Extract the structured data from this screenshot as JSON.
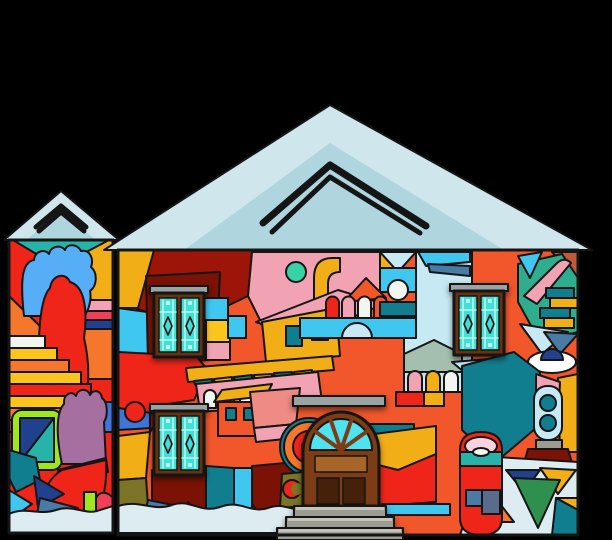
{
  "scene": {
    "type": "illustration",
    "description": "Colorful abstract mural covering the facades of two adjoining houses with pale-blue gabled roofs, an arched brown double door with cyan fanlight, three brown-framed teal-glass windows and gray entry steps, on a black background",
    "background": "#000000",
    "house_count": 2,
    "window_count": 3,
    "door_step_count": 3
  },
  "palette": {
    "roof_light": "#cfe7ec",
    "roof_mid": "#afd6de",
    "roof_ridge": "#eaf5f7",
    "red": "#f0251a",
    "crimson": "#f04058",
    "dark_red": "#9c1508",
    "wine": "#7a1205",
    "orange_red": "#f2572c",
    "orange": "#f4772b",
    "gold": "#f2ae17",
    "yellow": "#fcc51e",
    "off_white": "#f2f6f1",
    "white": "#ffffff",
    "pink": "#f2a3b3",
    "pale_pink": "#f6d4de",
    "salmon": "#ee8b84",
    "sky_blue": "#55aef6",
    "cyan": "#3fc7ef",
    "pale_blue": "#c6e9f3",
    "snow": "#dcecf1",
    "teal": "#27b3a8",
    "dark_teal": "#107e8f",
    "sea_green": "#2fae8f",
    "mint": "#35d3a5",
    "steel": "#4a7ba6",
    "slate": "#5a6b8c",
    "navy": "#21418f",
    "royal": "#3f74d8",
    "green": "#2f8f4e",
    "lime": "#9fe61f",
    "mauve": "#a56f9f",
    "rust": "#c05a3a",
    "olive": "#7c7427",
    "sage": "#a4bfae",
    "door_brown": "#7c3c15",
    "frame_brown": "#66320f",
    "dark_brown": "#45210a",
    "light_brown": "#a8652a",
    "khaki": "#c9a24a",
    "glass_teal": "#3fe0d6",
    "pale_glass": "#bef4ee",
    "fan_cyan": "#4fe3f2",
    "lintel_gray": "#9aa4a3",
    "step_gray": "#9c9c92",
    "step_light": "#c4c4ba"
  }
}
